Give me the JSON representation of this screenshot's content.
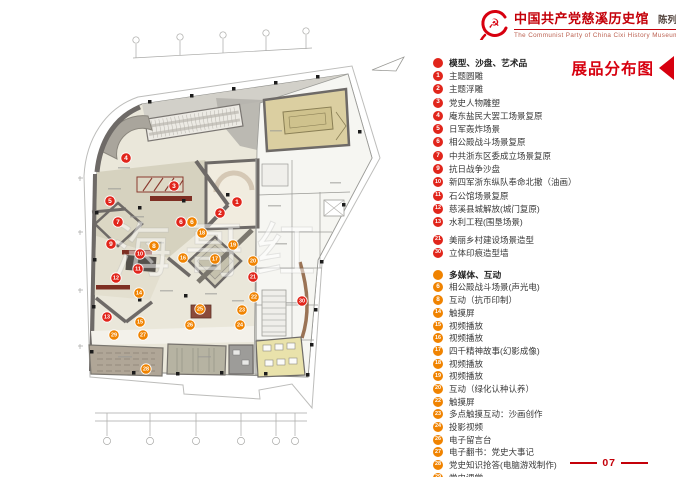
{
  "brand": {
    "emblem_icon": "party-emblem-icon",
    "title_cn": "中国共产党慈溪历史馆",
    "subtitle_cn": "陈列布展设计施工方案",
    "title_en": "The Communist Party of China Cixi  History Museum"
  },
  "legend_title": {
    "text": "展品分布图"
  },
  "page_number": "07",
  "colors": {
    "accent_red": "#c40009",
    "marker_red": "#e1251b",
    "marker_orange": "#f08300"
  },
  "legend": {
    "sections": [
      {
        "label": "模型、沙盘、艺术品",
        "color": "#e1251b",
        "items": [
          {
            "num": "1",
            "label": "主题圆雕"
          },
          {
            "num": "2",
            "label": "主题浮雕"
          },
          {
            "num": "3",
            "label": "党史人物雕塑"
          },
          {
            "num": "4",
            "label": "庵东盐民大罢工场景复原"
          },
          {
            "num": "5",
            "label": "日军轰炸场景"
          },
          {
            "num": "6",
            "label": "相公殿战斗场景复原"
          },
          {
            "num": "7",
            "label": "中共浙东区委成立场景复原"
          },
          {
            "num": "9",
            "label": "抗日战争沙盘"
          },
          {
            "num": "10",
            "label": "新四军浙东纵队奉命北撤（油画）"
          },
          {
            "num": "11",
            "label": "石公馆场景复原"
          },
          {
            "num": "12",
            "label": "慈溪县城解放(城门复原)"
          },
          {
            "num": "13",
            "label": "水利工程(围垦场景)"
          },
          {
            "num": "21",
            "label": "美丽乡村建设场景造型",
            "gap_before": true
          },
          {
            "num": "30",
            "label": "立体印痕造型墙"
          }
        ]
      },
      {
        "label": "多媒体、互动",
        "color": "#f08300",
        "items": [
          {
            "num": "6",
            "label": "相公殿战斗场景(声光电)"
          },
          {
            "num": "8",
            "label": "互动（抗币印制）"
          },
          {
            "num": "14",
            "label": "触摸屏"
          },
          {
            "num": "15",
            "label": "视频播放"
          },
          {
            "num": "16",
            "label": "视频播放"
          },
          {
            "num": "17",
            "label": "四千精神故事(幻影成像)"
          },
          {
            "num": "18",
            "label": "视频播放"
          },
          {
            "num": "19",
            "label": "视频播放"
          },
          {
            "num": "20",
            "label": "互动（绿化认种认养）"
          },
          {
            "num": "22",
            "label": "触摸屏"
          },
          {
            "num": "23",
            "label": "多点触摸互动：沙画创作"
          },
          {
            "num": "24",
            "label": "投影视频"
          },
          {
            "num": "26",
            "label": "电子留言台"
          },
          {
            "num": "27",
            "label": "电子翻书：党史大事记"
          },
          {
            "num": "28",
            "label": "党史知识抢答(电脑游戏制作)"
          },
          {
            "num": "29",
            "label": "党史课堂"
          }
        ]
      }
    ]
  },
  "plan": {
    "watermark": "海哥红",
    "markers": [
      {
        "num": "1",
        "type": "red",
        "x": 237,
        "y": 202
      },
      {
        "num": "2",
        "type": "red",
        "x": 220,
        "y": 213
      },
      {
        "num": "3",
        "type": "red",
        "x": 174,
        "y": 186
      },
      {
        "num": "4",
        "type": "red",
        "x": 126,
        "y": 158
      },
      {
        "num": "5",
        "type": "red",
        "x": 110,
        "y": 201
      },
      {
        "num": "6",
        "type": "red",
        "x": 181,
        "y": 222
      },
      {
        "num": "7",
        "type": "red",
        "x": 118,
        "y": 222
      },
      {
        "num": "9",
        "type": "red",
        "x": 111,
        "y": 244
      },
      {
        "num": "10",
        "type": "red",
        "x": 140,
        "y": 254
      },
      {
        "num": "11",
        "type": "red",
        "x": 138,
        "y": 269
      },
      {
        "num": "12",
        "type": "red",
        "x": 116,
        "y": 278
      },
      {
        "num": "13",
        "type": "red",
        "x": 107,
        "y": 317
      },
      {
        "num": "21",
        "type": "red",
        "x": 253,
        "y": 277
      },
      {
        "num": "30",
        "type": "red",
        "x": 302,
        "y": 301
      },
      {
        "num": "6",
        "type": "orange",
        "x": 192,
        "y": 222
      },
      {
        "num": "8",
        "type": "orange",
        "x": 154,
        "y": 246
      },
      {
        "num": "14",
        "type": "orange",
        "x": 139,
        "y": 293
      },
      {
        "num": "15",
        "type": "orange",
        "x": 140,
        "y": 322
      },
      {
        "num": "16",
        "type": "orange",
        "x": 183,
        "y": 258
      },
      {
        "num": "17",
        "type": "orange",
        "x": 215,
        "y": 259
      },
      {
        "num": "18",
        "type": "orange",
        "x": 202,
        "y": 233
      },
      {
        "num": "19",
        "type": "orange",
        "x": 233,
        "y": 245
      },
      {
        "num": "20",
        "type": "orange",
        "x": 253,
        "y": 261
      },
      {
        "num": "22",
        "type": "orange",
        "x": 254,
        "y": 297
      },
      {
        "num": "23",
        "type": "orange",
        "x": 242,
        "y": 310
      },
      {
        "num": "24",
        "type": "orange",
        "x": 240,
        "y": 325
      },
      {
        "num": "25",
        "type": "orange",
        "x": 200,
        "y": 309
      },
      {
        "num": "26",
        "type": "orange",
        "x": 190,
        "y": 325
      },
      {
        "num": "27",
        "type": "orange",
        "x": 143,
        "y": 335
      },
      {
        "num": "28",
        "type": "orange",
        "x": 146,
        "y": 369
      },
      {
        "num": "29",
        "type": "orange",
        "x": 114,
        "y": 335
      }
    ]
  }
}
